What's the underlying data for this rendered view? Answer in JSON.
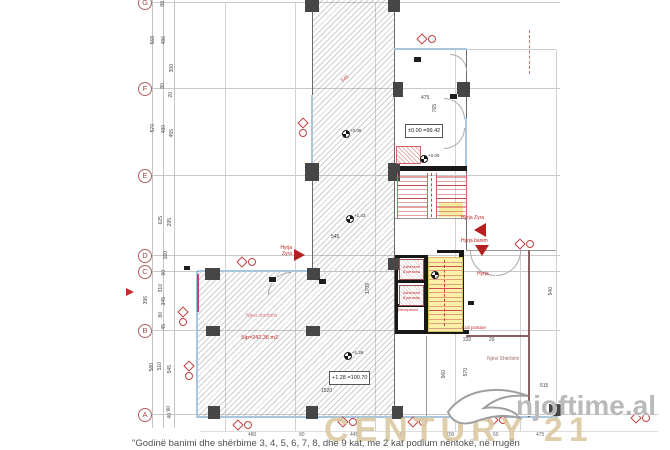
{
  "grid_rows": [
    "G",
    "F",
    "E",
    "D",
    "C",
    "B",
    "A"
  ],
  "dims": {
    "left": [
      "568",
      "486",
      "300",
      "80",
      "80",
      "20",
      "570",
      "480",
      "455",
      "625",
      "295",
      "125",
      "160",
      "90",
      "310",
      "396",
      "345",
      "80",
      "45",
      "580",
      "510",
      "545",
      "90",
      "40"
    ],
    "plan": [
      "475",
      "765",
      "545",
      "545",
      "1709",
      "220",
      "29",
      "515",
      "1520",
      "540",
      "570",
      "560"
    ],
    "bottom": [
      "480",
      "80",
      "445",
      "84",
      "700",
      "60",
      "475"
    ]
  },
  "levels": {
    "entry_box": "±0.00 =99.42",
    "room_box": "+1.28 =100.70",
    "bm": [
      "+0.06",
      "+0.00",
      "+1.43",
      "+1.28"
    ]
  },
  "labels": {
    "hyrja_zyra": "Hyrja Zyra",
    "hyrja_banim": "Hyrja banim",
    "hyrja": "Hyrja",
    "hyrja_l1": "Hyrja",
    "hyrja_l2": "Zyra",
    "lift1": "Ashensori",
    "lift2": "8 persona",
    "recepsioni": "Recepsioni",
    "kuti_postare": "Kuti postare",
    "room_name": "Njesi sherbimi",
    "room_area": "Sip=242.36 m2",
    "service_room": "Njësi Shërbimi"
  },
  "watermarks": {
    "site": "njoftime.al",
    "agency": "CENTURY 21",
    "caption": "\"Godinë banimi dhe shërbime 3, 4, 5, 6, 7, 8, dhe 9 kat, me 2 kat podium nëntokë, në rrugën"
  }
}
